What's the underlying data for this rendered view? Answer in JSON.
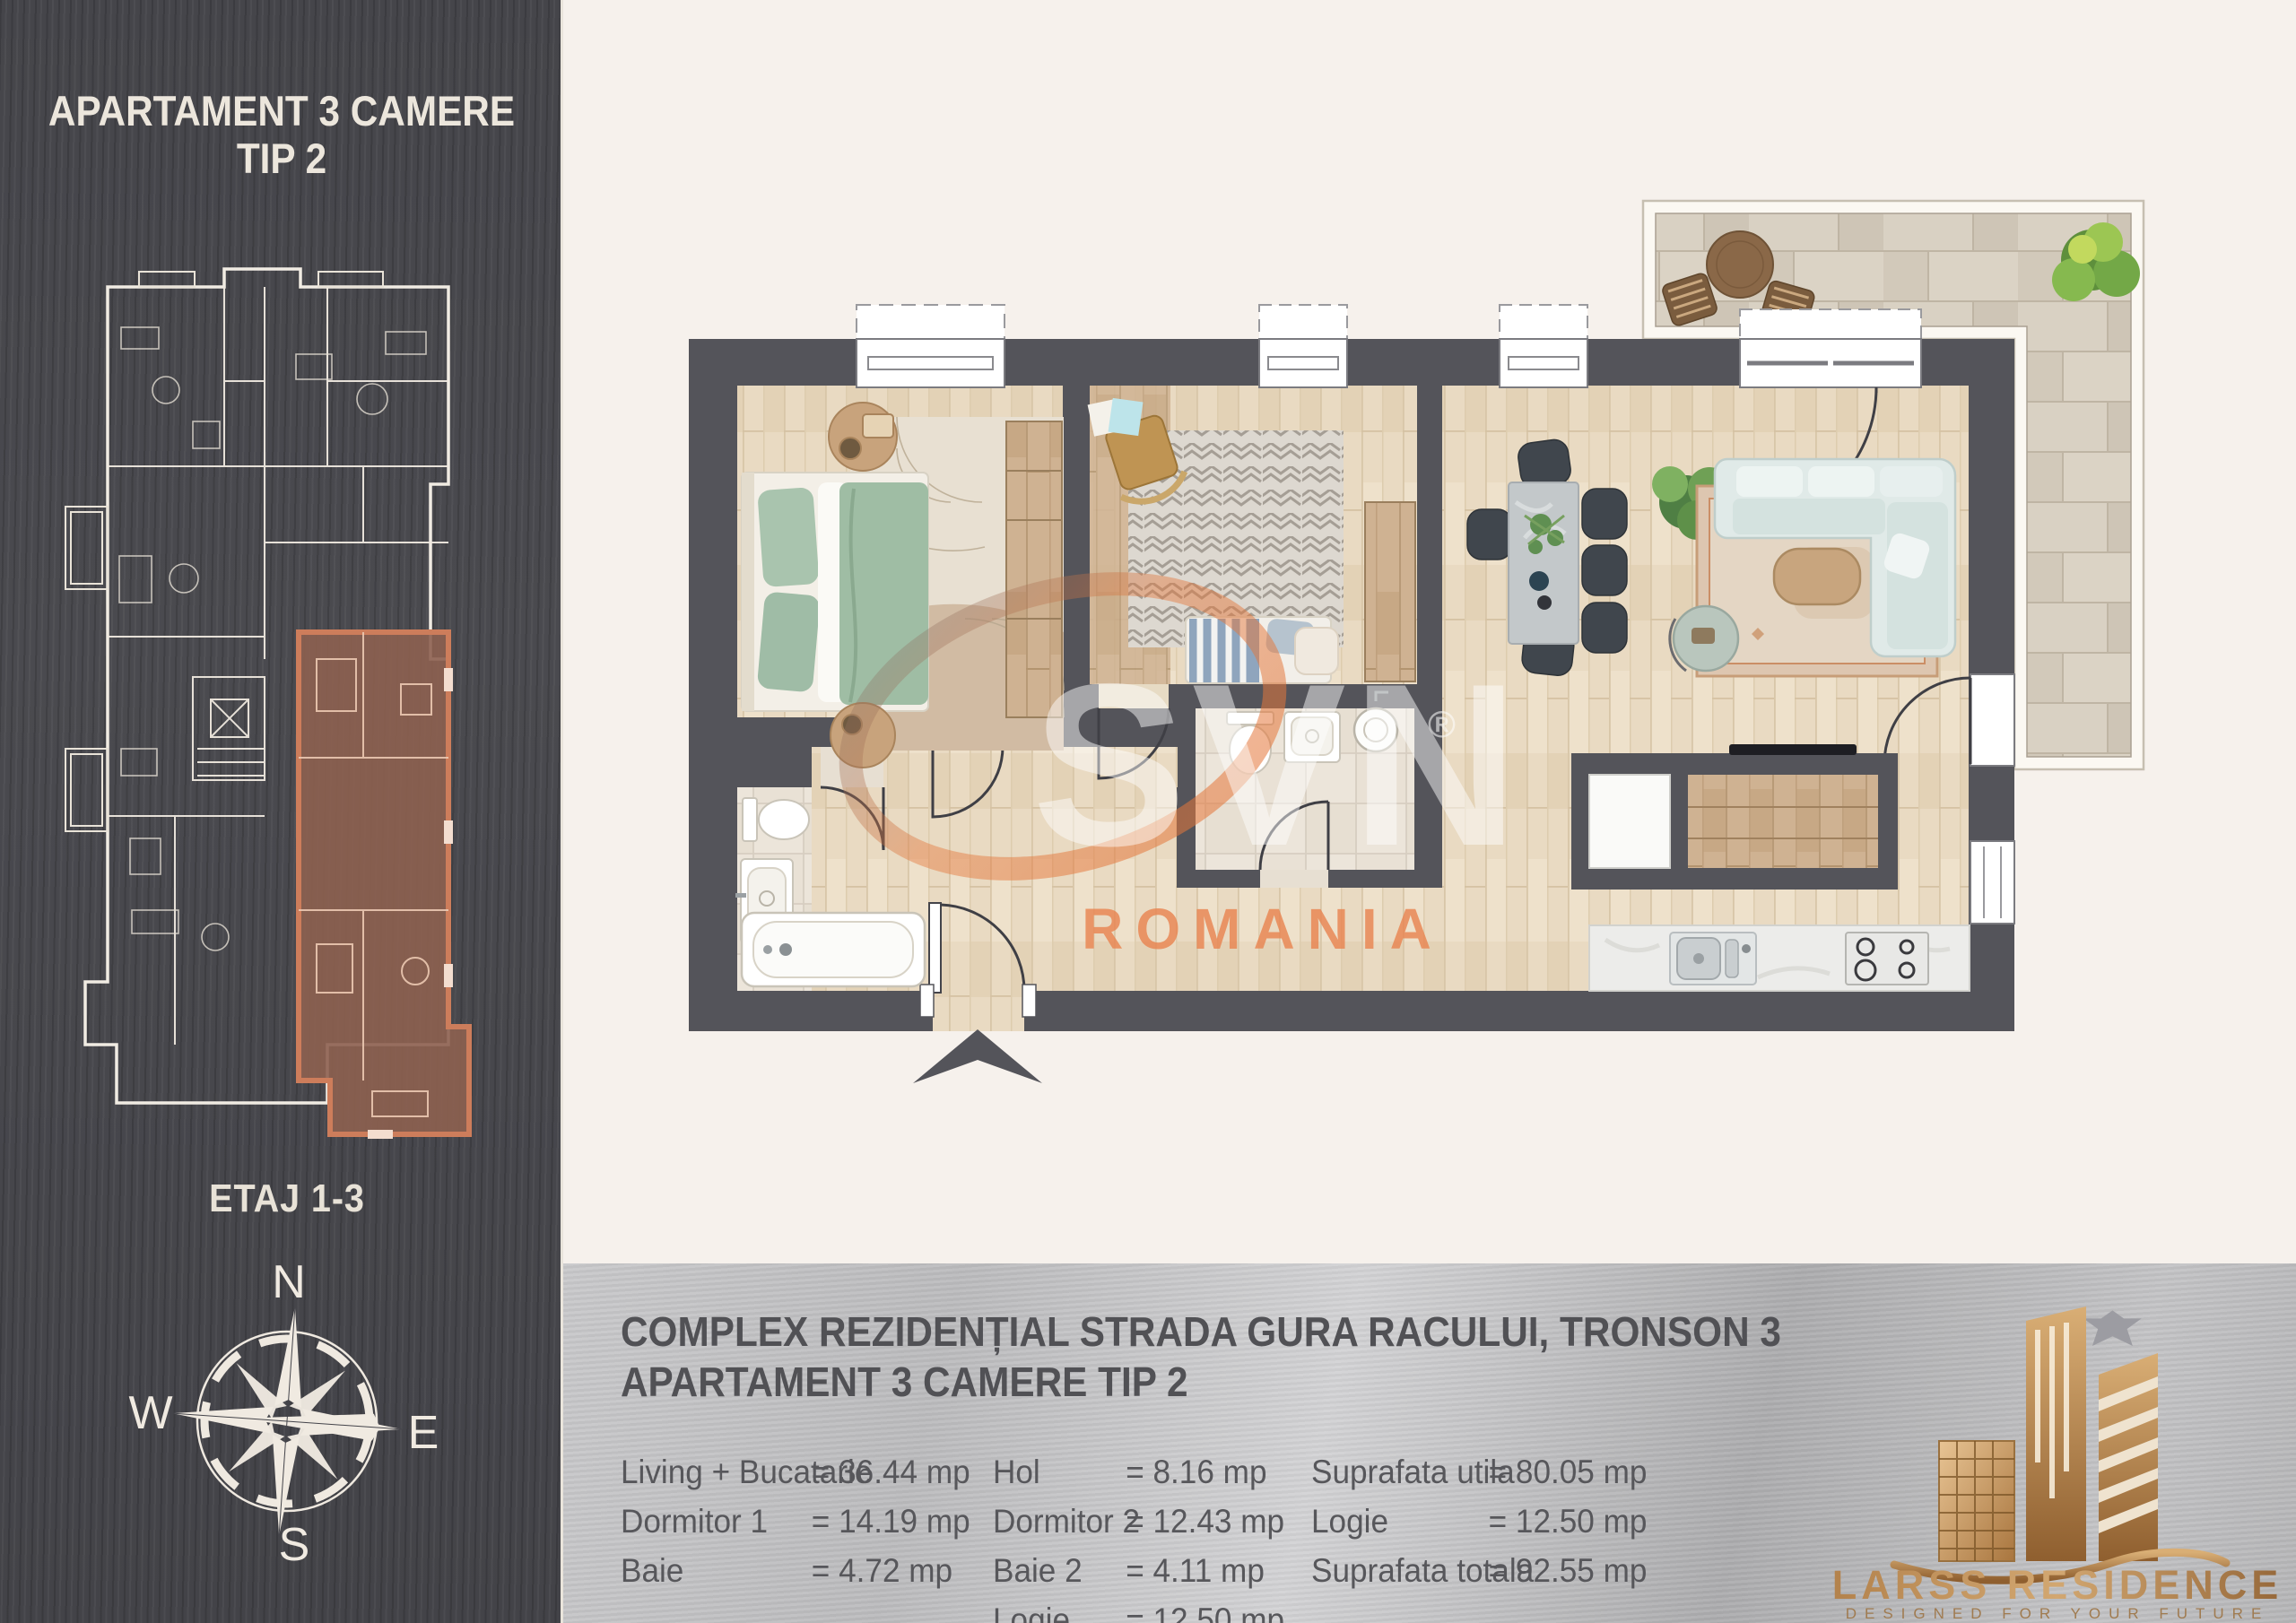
{
  "sidebar": {
    "title_line1": "APARTAMENT 3 CAMERE",
    "title_line2": "TIP 2",
    "floor_label": "ETAJ 1-3",
    "compass": {
      "n": "N",
      "e": "E",
      "s": "S",
      "w": "W"
    }
  },
  "watermark": {
    "brand": "SVN",
    "registered": "®",
    "region": "ROMANIA"
  },
  "footer": {
    "project_line1": "COMPLEX REZIDENȚIAL STRADA GURA RACULUI, TRONSON 3",
    "project_line2": "APARTAMENT 3 CAMERE TIP 2",
    "areas_col1": [
      {
        "label": "Living + Bucatarie",
        "value": "= 36.44 mp"
      },
      {
        "label": "Dormitor 1",
        "value": "= 14.19 mp"
      },
      {
        "label": "Baie",
        "value": "= 4.72 mp"
      }
    ],
    "areas_col2": [
      {
        "label": "Hol",
        "value": "= 8.16 mp"
      },
      {
        "label": "Dormitor 2",
        "value": "= 12.43 mp"
      },
      {
        "label": "Baie 2",
        "value": "= 4.11 mp"
      },
      {
        "label": "Logie",
        "value": "= 12.50 mp"
      }
    ],
    "areas_col3": [
      {
        "label": "Suprafata utila",
        "value": "= 80.05 mp"
      },
      {
        "label": "Logie",
        "value": "= 12.50 mp"
      },
      {
        "label": "Suprafata totala",
        "value": "= 92.55 mp"
      }
    ],
    "brand": {
      "name": "LARSS RESIDENCE",
      "tagline": "DESIGNED FOR YOUR FUTURE"
    }
  },
  "colors": {
    "sidebar_bg": "#47474b",
    "canvas_bg": "#f6f1ec",
    "wall": "#54545a",
    "highlight_wall": "#cd7d5b",
    "highlight_fill": "#8d6150",
    "gold": "#b98a5e",
    "watermark_orange": "#e4773b",
    "footer_text": "#57575b"
  }
}
